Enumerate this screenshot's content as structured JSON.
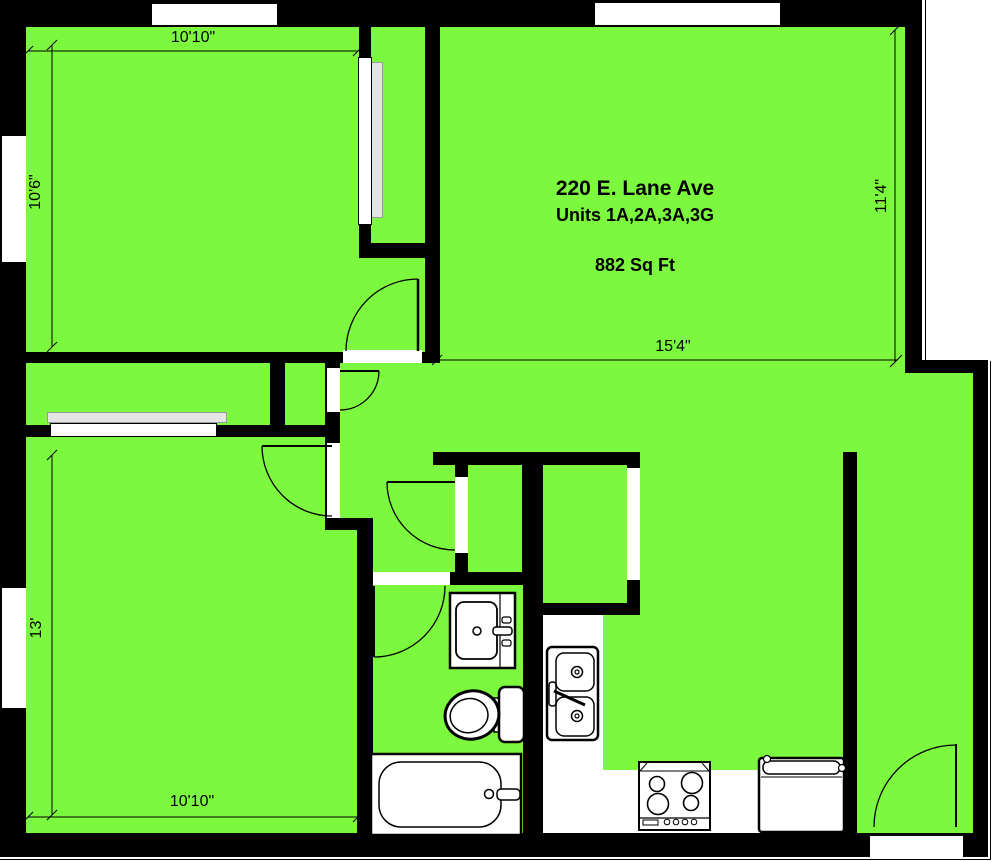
{
  "title_block": {
    "address": "220 E. Lane Ave",
    "units": "Units 1A,2A,3A,3G",
    "area": "882 Sq Ft"
  },
  "dimensions": {
    "top": "10'10\"",
    "left_upper": "10'6\"",
    "right": "11'4\"",
    "center": "15'4\"",
    "left_lower": "13'",
    "bottom": "10'10\""
  },
  "colors": {
    "floor": "#7CF83E",
    "wall": "#000000",
    "opening": "#FFFFFF",
    "slider": "#E4E4E4"
  },
  "fixtures": [
    "bathroom-vanity",
    "toilet",
    "bathtub",
    "kitchen-double-sink",
    "stove",
    "washer",
    "entry-door",
    "swing-doors",
    "closet-sliding-doors",
    "windows"
  ]
}
